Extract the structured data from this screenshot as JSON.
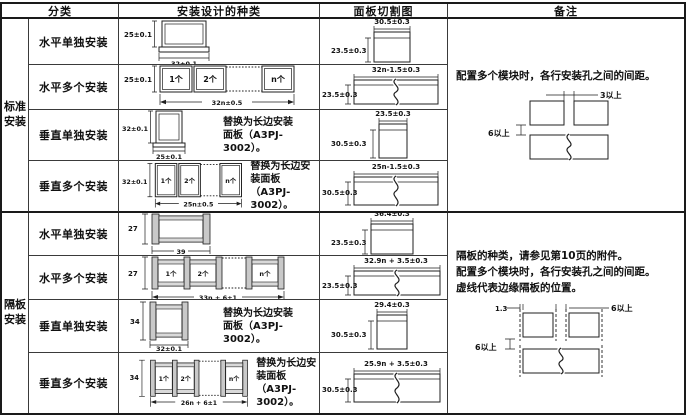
{
  "columns": [
    "分类",
    "安装设计的种类",
    "面板切割图",
    "备注"
  ],
  "groups": [
    {
      "label": "标准安装"
    },
    {
      "label": "隔板安装"
    }
  ],
  "rows": [
    {
      "category": "水平单独安装",
      "design": {
        "height_dim": "25±0.1",
        "width_dim": "32±0.1"
      },
      "cutout": {
        "width_dim": "30.5±0.3",
        "height_dim": "23.5±0.3"
      }
    },
    {
      "category": "水平多个安装",
      "design": {
        "height_dim": "25±0.1",
        "width_dim": "32n±0.5",
        "units": [
          "1个",
          "2个",
          "n个"
        ]
      },
      "cutout": {
        "width_dim": "32n-1.5±0.3",
        "height_dim": "23.5±0.3"
      }
    },
    {
      "category": "垂直单独安装",
      "design": {
        "height_dim": "32±0.1",
        "width_dim": "25±0.1",
        "note": "替换为长边安装面板（A3PJ-3002）。"
      },
      "cutout": {
        "width_dim": "23.5±0.3",
        "height_dim": "30.5±0.3"
      }
    },
    {
      "category": "垂直多个安装",
      "design": {
        "height_dim": "32±0.1",
        "width_dim": "25n±0.5",
        "units": [
          "1个",
          "2个",
          "n个"
        ],
        "note": "替换为长边安装面板（A3PJ-3002）。"
      },
      "cutout": {
        "width_dim": "25n-1.5±0.3",
        "height_dim": "30.5±0.3"
      }
    },
    {
      "category": "水平单独安装",
      "design": {
        "height_dim": "27",
        "width_dim": "39"
      },
      "cutout": {
        "width_dim": "36.4±0.3",
        "height_dim": "23.5±0.3"
      }
    },
    {
      "category": "水平多个安装",
      "design": {
        "height_dim": "27",
        "width_dim": "33n + 6±1",
        "units": [
          "1个",
          "2个",
          "n个"
        ]
      },
      "cutout": {
        "width_dim": "32.9n + 3.5±0.3",
        "height_dim": "23.5±0.3"
      }
    },
    {
      "category": "垂直单独安装",
      "design": {
        "height_dim": "34",
        "width_dim": "32±0.1",
        "note": "替换为长边安装面板（A3PJ-3002）。"
      },
      "cutout": {
        "width_dim": "29.4±0.3",
        "height_dim": "30.5±0.3"
      }
    },
    {
      "category": "垂直多个安装",
      "design": {
        "height_dim": "34",
        "width_dim": "26n + 6±1",
        "units": [
          "1个",
          "2个",
          "n个"
        ],
        "note": "替换为长边安装面板（A3PJ-3002）。"
      },
      "cutout": {
        "width_dim": "25.9n + 3.5±0.3",
        "height_dim": "30.5±0.3"
      }
    }
  ],
  "remarks": [
    {
      "lines": [
        "配置多个模块时，各行安装孔之间的间距。"
      ],
      "labels": {
        "horizontal_gap": "3以上",
        "vertical_gap": "6以上"
      }
    },
    {
      "lines": [
        "隔板的种类，请参见第10页的附件。",
        "配置多个模块时，各行安装孔之间的间距。",
        "虚线代表边缘隔板的位置。"
      ],
      "labels": {
        "partition_offset": "1.3",
        "horizontal_gap": "6以上",
        "vertical_gap": "6以上"
      }
    }
  ],
  "colors": {
    "line": "#1a1a1a",
    "partition_fill": "#c9c9c9",
    "background": "#ffffff"
  }
}
